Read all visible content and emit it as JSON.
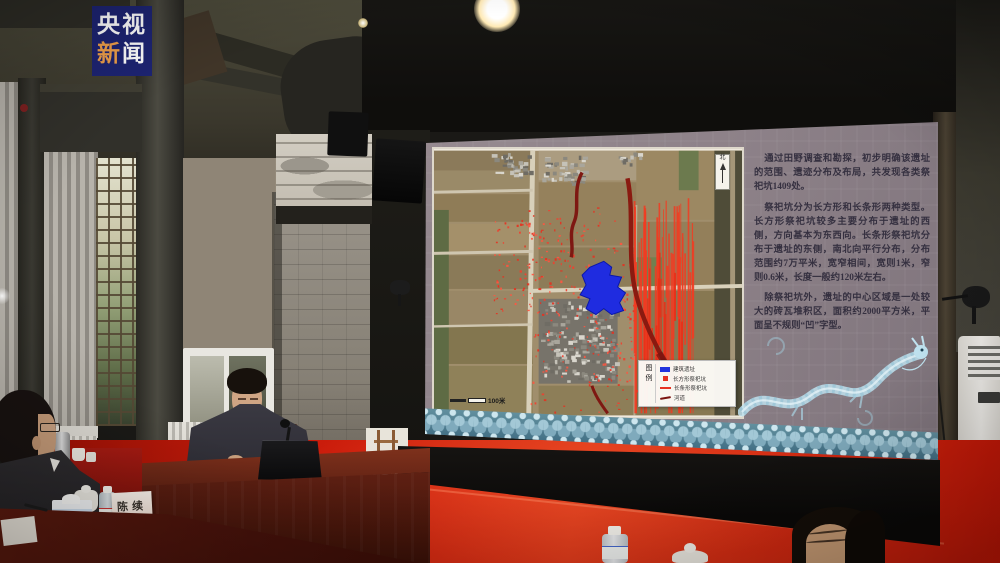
{
  "watermark": {
    "top": "央视",
    "accent": "新",
    "rest": "闻"
  },
  "slide": {
    "paragraphs": [
      "通过田野调查和勘探，初步明确该遗址的范围、遗迹分布及布局，共发现各类祭祀坑1409处。",
      "祭祀坑分为长方形和长条形两种类型。长方形祭祀坑较多主要分布于遗址的西侧，方向基本为东西向。长条形祭祀坑分布于遗址的东侧，南北向平行分布，分布范围约7万平米，宽窄相间，宽则1米，窄则0.6米，长度一般约120米左右。",
      "除祭祀坑外，遗址的中心区域是一处较大的砖瓦堆积区，面积约2000平方米，平面呈不规则“凹”字型。"
    ],
    "map": {
      "north_label": "北",
      "scale_label": "100米",
      "legend_title": "图例",
      "legend": [
        {
          "label": "建筑遗址",
          "color": "#2233dd"
        },
        {
          "label": "长方形祭祀坑",
          "color": "#e63222"
        },
        {
          "label": "长条形祭祀坑",
          "color": "#e63222"
        },
        {
          "label": "河道",
          "color": "#7a1410"
        }
      ]
    }
  },
  "foreground": {
    "name_card": "陈续"
  },
  "colors": {
    "carpet": "#cf1c0d",
    "screen_bg": "#8e8289",
    "marker_red": "#e63222",
    "building_blue": "#2233dd",
    "river_dark_red": "#7a1410",
    "dragon_blue": "#aed6e6",
    "logo_bg": "#1d2473",
    "logo_accent": "#f0a04a"
  }
}
